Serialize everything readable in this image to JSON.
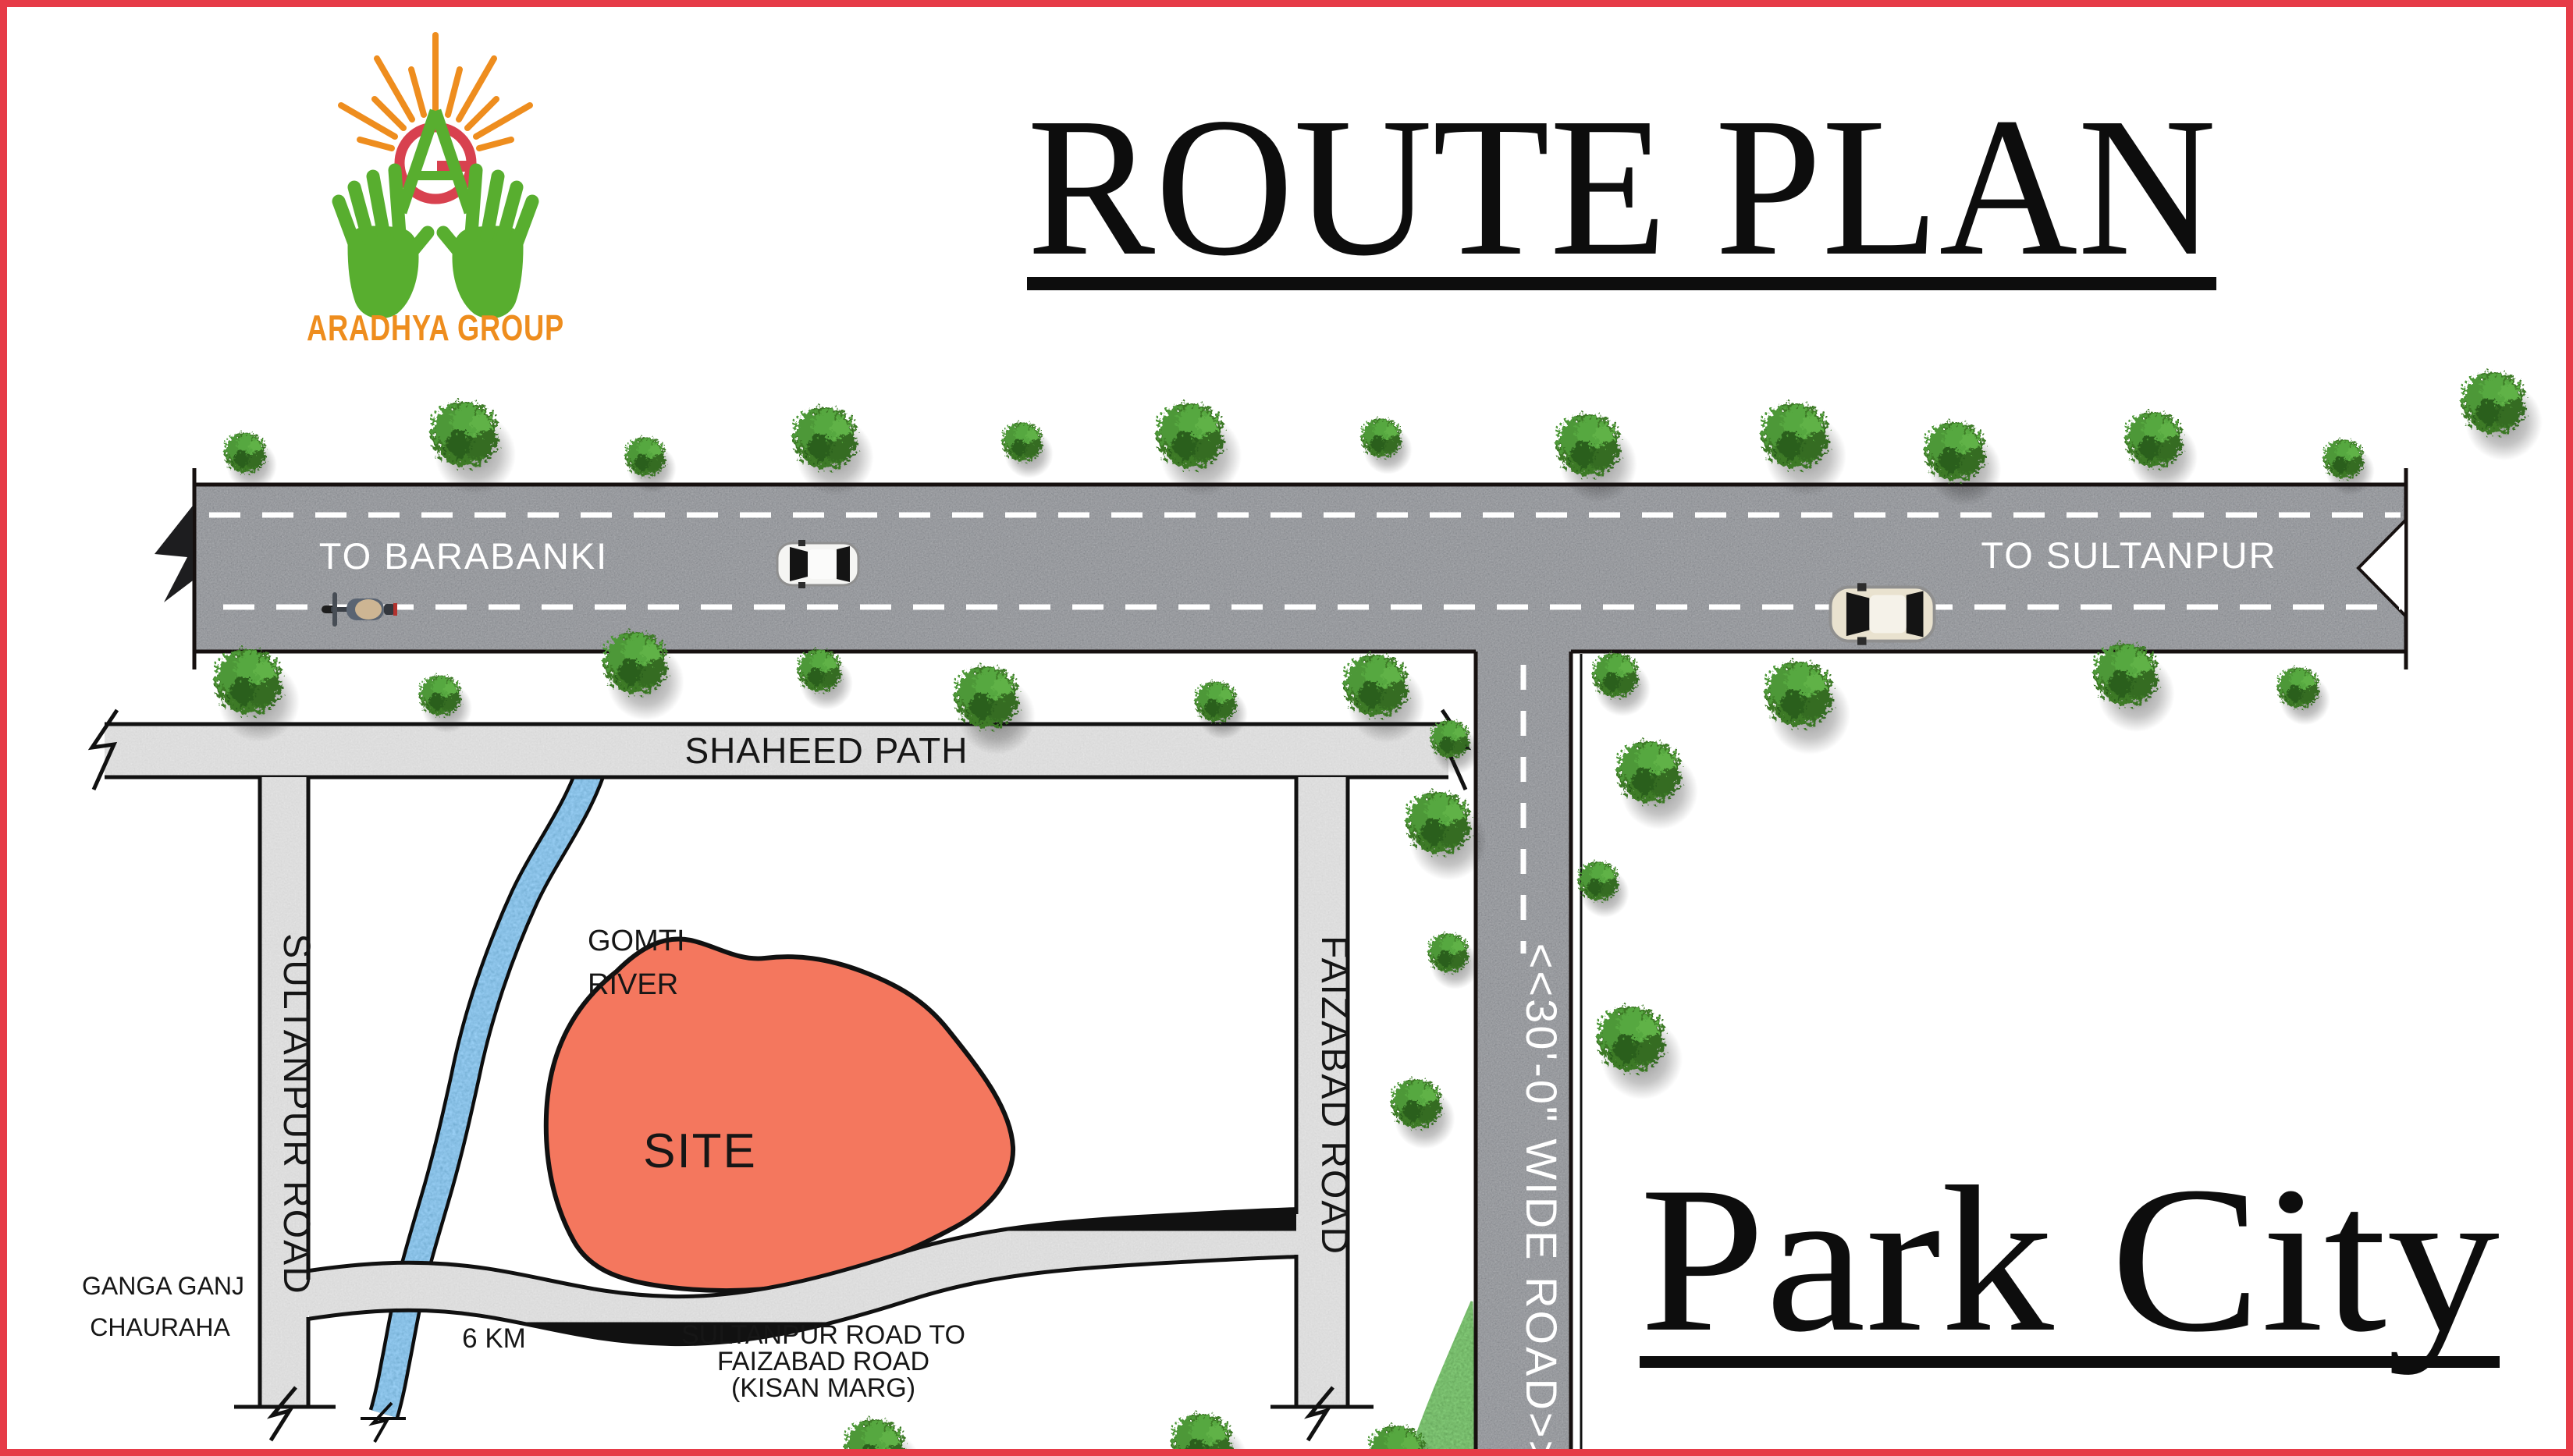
{
  "poster": {
    "title": "ROUTE PLAN",
    "project_name": "Park City",
    "brand_name": "ARADHYA GROUP",
    "colors": {
      "frame_red": "#E63B47",
      "brand_orange": "#EE8D1E",
      "brand_green": "#58AE2F",
      "brand_ring_red": "#D8414F",
      "site_fill": "#F4775E",
      "asphalt_grey": "#4a4c50",
      "road_grey": "#B5B5B5",
      "river_blue": "#4AA0E0"
    }
  },
  "map": {
    "highway": {
      "left_label": "TO BARABANKI",
      "right_label": "TO SULTANPUR"
    },
    "wide_road_label": "<<30'-0\" WIDE ROAD>>",
    "shaheed_path_label": "SHAHEED PATH",
    "sultanpur_road_label": "SULTANPUR ROAD",
    "faizabad_road_label": "FAIZABAD ROAD",
    "kisan_marg": {
      "line1": "SULTANPUR ROAD TO",
      "line2": "FAIZABAD ROAD",
      "line3": "(KISAN MARG)"
    },
    "river": {
      "line1": "GOMTI",
      "line2": "RIVER"
    },
    "site_label": "SITE",
    "ganga_ganj": {
      "line1": "GANGA GANJ",
      "line2": "CHAURAHA"
    },
    "distance_label": "6 KM"
  }
}
